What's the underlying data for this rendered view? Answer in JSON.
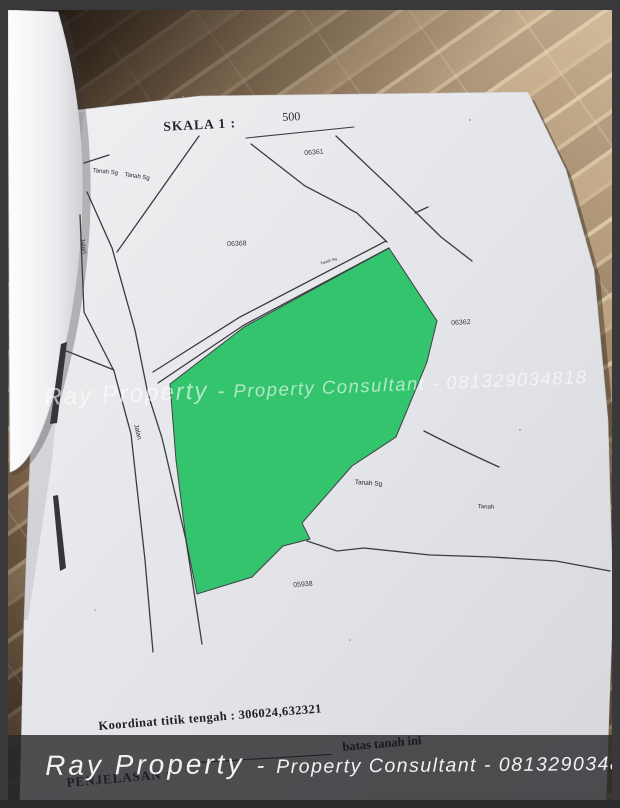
{
  "map": {
    "scale": {
      "label": "SKALA 1 :",
      "value": "500"
    },
    "parcel_ids": {
      "top": "06361",
      "left": "06368",
      "right": "06362",
      "bottom": "05938"
    },
    "area_labels": {
      "tanah_sg_a": "Tanah Sg",
      "tanah_sg_b": "Tanah Sg",
      "jalan_upper": "Jalan",
      "jalan_lower": "Jalan",
      "strip_small": "Tanah Sg",
      "tanah_sg_mid": "Tanah Sg",
      "tanah_right": "Tanah"
    },
    "coordinates_note": "Koordinat titik tengah : 306024,632321",
    "highlight_color": "#2cc368"
  },
  "watermark": {
    "brand": "Ray Property",
    "separator": "-",
    "tagline": "Property Consultant - 081329034818"
  },
  "footer": {
    "brand": "Ray Property",
    "separator": "-",
    "tagline": "Property Consultant - 081329034818",
    "legend_title": "PENJELASAN :",
    "legend_item": "batas tanah ini"
  }
}
